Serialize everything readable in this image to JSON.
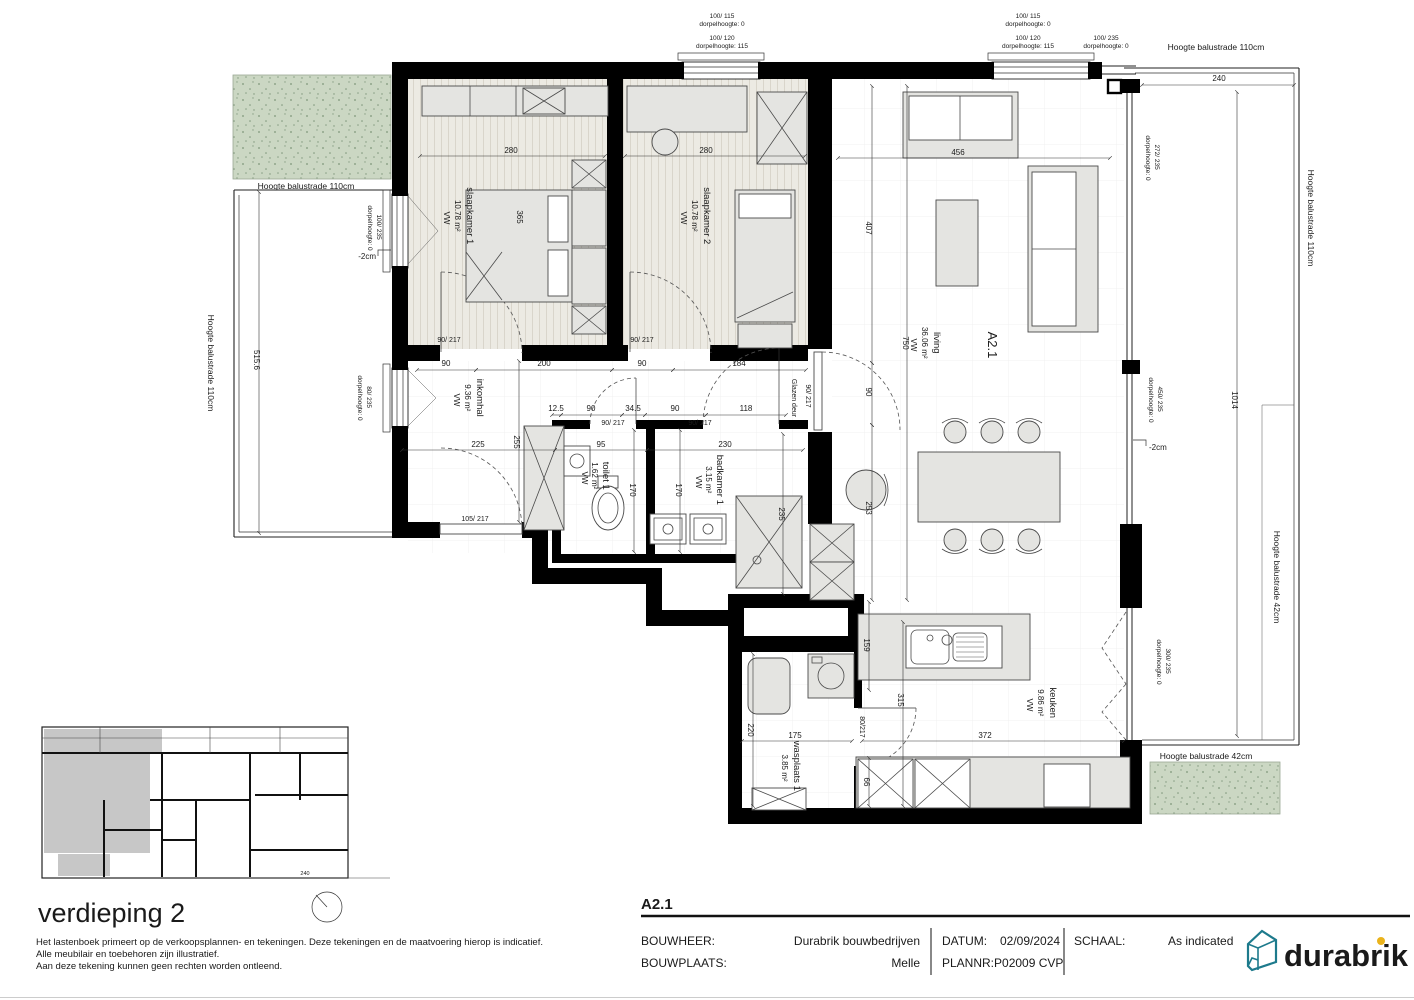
{
  "colors": {
    "wall": "#000000",
    "furniture_fill": "#e4e4e1",
    "terrace_green": "#cbd7c3",
    "terrace_green_dot": "#7e967a",
    "overview_gray": "#c7c7c7",
    "logo_teal": "#1d7a8c",
    "logo_text": "#8a8a8a",
    "logo_dot": "#eab31b"
  },
  "unit_label": "A2.1",
  "rooms": {
    "slaapkamer1": {
      "name": "slaapkamer 1",
      "area": "10.78 m²",
      "floor": "VW"
    },
    "slaapkamer2": {
      "name": "slaapkamer 2",
      "area": "10.78 m²",
      "floor": "VW"
    },
    "living": {
      "name": "living",
      "area": "36.06 m²",
      "floor": "VW"
    },
    "inkomhal": {
      "name": "inkomhal",
      "area": "9.36 m²",
      "floor": "VW"
    },
    "toilet1": {
      "name": "toilet 1",
      "area": "1.62 m²",
      "floor": "VW"
    },
    "badkamer1": {
      "name": "badkamer 1",
      "area": "3.15 m²",
      "floor": "VW"
    },
    "keuken": {
      "name": "keuken",
      "area": "9.86 m²",
      "floor": "VW"
    },
    "wasplaats1": {
      "name": "wasplaats 1",
      "area": "3.85 m²"
    }
  },
  "doors": {
    "slaapkamer1": "90/ 217",
    "slaapkamer2": "90/ 217",
    "toilet": "90/ 217",
    "badkamer": "90/ 217",
    "entry": "105/ 217",
    "glazen_deur": "Glazen deur",
    "glazen_deur_size": "90/ 217",
    "wasplaats": "80/217"
  },
  "windows": {
    "top1": [
      "100/ 115",
      "dorpelhoogte: 0",
      "100/ 120",
      "dorpelhoogte: 115"
    ],
    "top2": [
      "100/ 115",
      "dorpelhoogte: 0",
      "100/ 120",
      "dorpelhoogte: 115",
      "100/ 235",
      "dorpelhoogte: 0"
    ],
    "left1": [
      "100/ 235",
      "dorpelhoogte: 0"
    ],
    "left2": [
      "80/ 235",
      "dorpelhoogte: 0"
    ],
    "right1": [
      "272/ 235",
      "dorpelhoogte: 0"
    ],
    "right2": [
      "450/ 235",
      "dorpelhoogte: 0"
    ],
    "right3": [
      "300/ 235",
      "dorpelhoogte: 0"
    ]
  },
  "balustrades": {
    "top_right": "Hoogte balustrade 110cm",
    "left_top": "Hoogte balustrade 110cm",
    "left_side": "Hoogte balustrade 110cm",
    "right_side": "Hoogte balustrade 110cm",
    "right_lower": "Hoogte balustrade 42cm",
    "bottom": "Hoogte balustrade 42cm"
  },
  "levels": {
    "left": "-2cm",
    "right": "-2cm"
  },
  "dims": {
    "bd1_width": "280",
    "bd2_width": "280",
    "sofa": "456",
    "living_depth": "407",
    "living_height": "750",
    "living_mid": "90",
    "living_low": "253",
    "bed1": "365",
    "hall_1": "90",
    "hall_2": "200",
    "hall_3": "90",
    "hall_4": "184",
    "sub_1": "12.5",
    "sub_2": "90",
    "sub_3": "34.5",
    "sub_4": "90",
    "sub_5": "118",
    "hall_width": "225",
    "toilet_width": "95",
    "bad_width": "230",
    "hall_depth": "255",
    "toilet_depth": "170",
    "bad_depth": "170",
    "shower": "235",
    "kitchen_depth": "315",
    "island": "159",
    "counter": "66",
    "wasplaats_depth": "220",
    "wasplaats_width": "175",
    "kitchen_width": "372",
    "terrace_width": "240",
    "terrace_height": "1014",
    "left_terrace": "515.6",
    "overview": "240"
  },
  "overview": {
    "title": "verdieping 2"
  },
  "disclaimer": [
    "Het lastenboek primeert op de verkoopsplannen- en tekeningen. Deze tekeningen en de maatvoering hierop is indicatief.",
    "Alle meubilair en toebehoren zijn illustratief.",
    "Aan deze tekening kunnen geen rechten worden ontleend."
  ],
  "titleblock": {
    "code": "A2.1",
    "bouwheer_label": "BOUWHEER:",
    "bouwheer": "Durabrik bouwbedrijven",
    "bouwplaats_label": "BOUWPLAATS:",
    "bouwplaats": "Melle",
    "datum_label": "DATUM:",
    "datum": "02/09/2024",
    "plannr": "PLANNR:P02009 CVP",
    "schaal_label": "SCHAAL:",
    "schaal": "As indicated",
    "logo": "durabrik"
  }
}
